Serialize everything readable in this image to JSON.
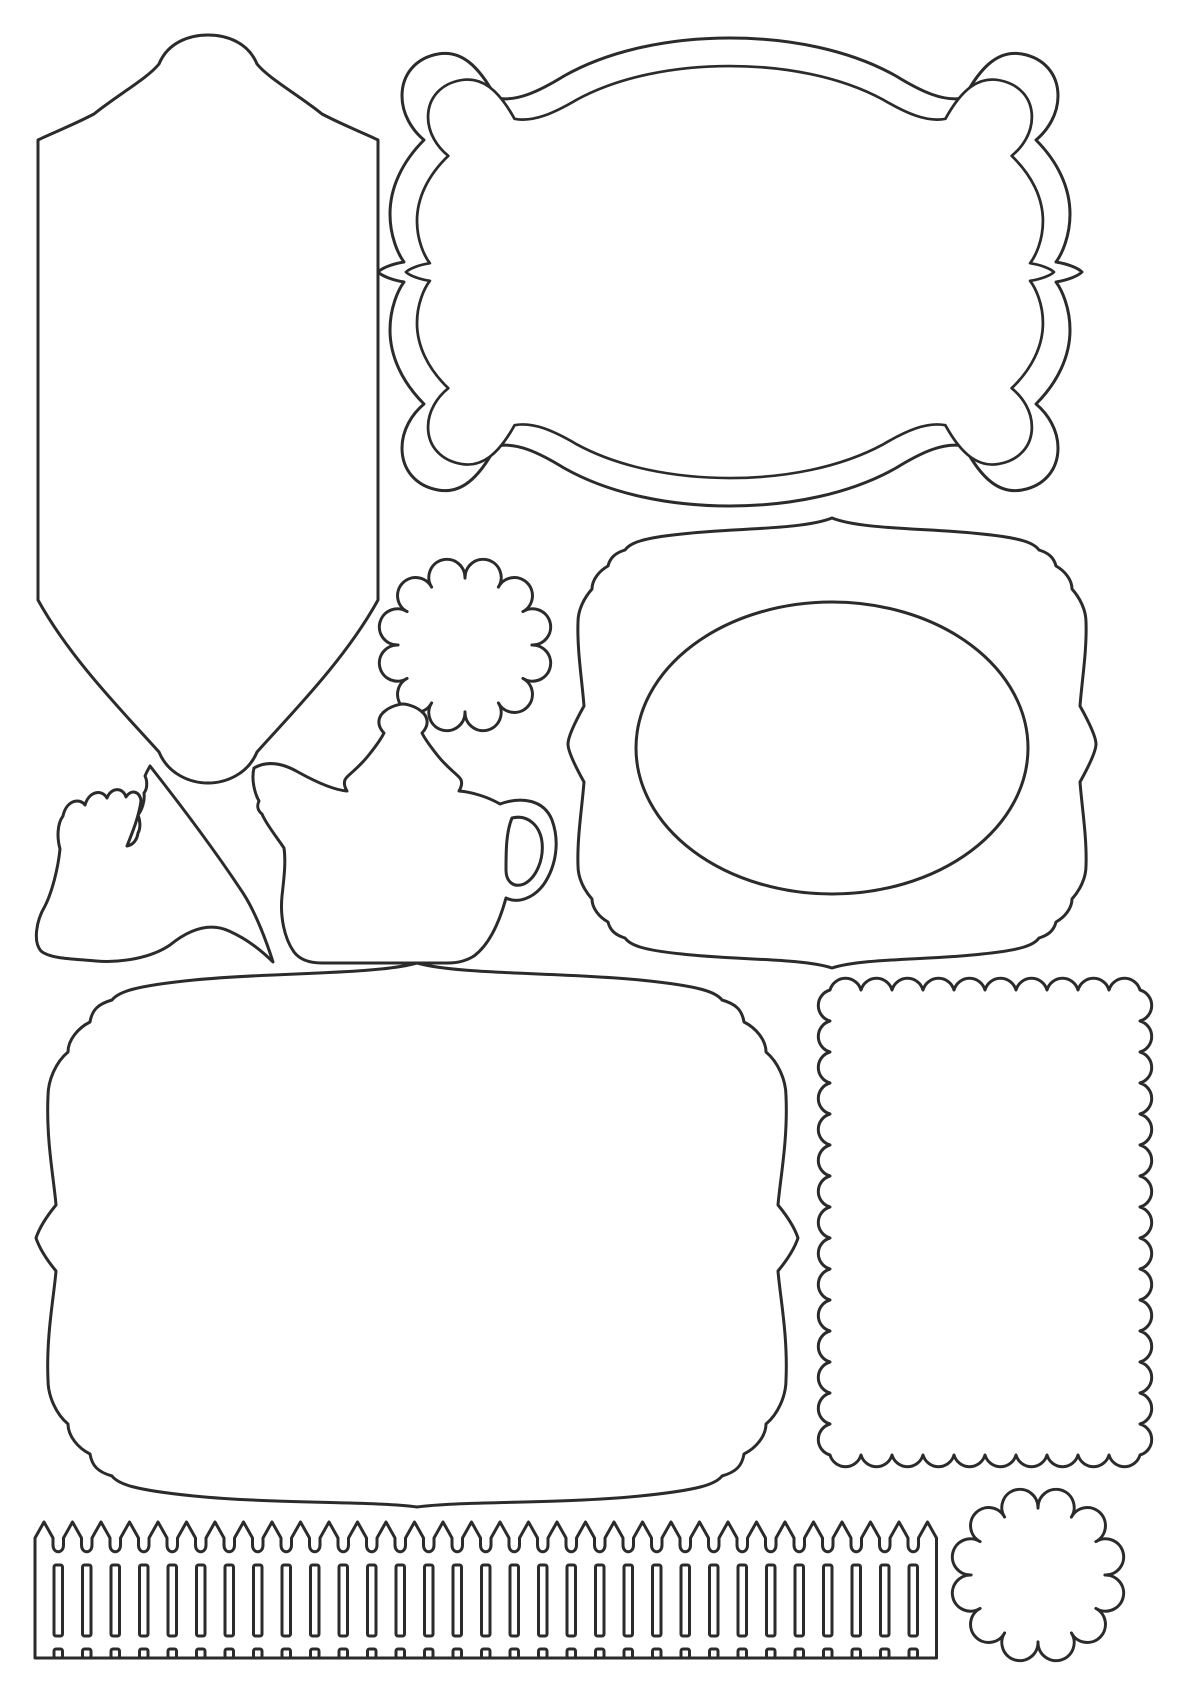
{
  "page": {
    "background_color": "#ffffff",
    "line_color": "#2b2b2b",
    "line_width": 3,
    "sheet_description": "Die-cut style craft template sheet of blank outline shapes: bracket frames, tall tag, oval frame, scalloped circles, scalloped rectangle, teapot, flying bird and picket fence"
  },
  "shapes": {
    "tall_label": {
      "label": "tall bracket tag",
      "bbox": [
        38,
        35,
        378,
        783
      ]
    },
    "double_bracket_frame": {
      "label": "double-outline bracket frame",
      "outlines": 2,
      "bbox": [
        375,
        33,
        1085,
        510
      ]
    },
    "scalloped_circle_large": {
      "label": "large scalloped circle",
      "center": [
        465,
        645
      ],
      "radius": 88,
      "lobes": 12
    },
    "teapot": {
      "label": "teapot outline",
      "bbox": [
        250,
        704,
        557,
        963
      ]
    },
    "bird": {
      "label": "flying bird outline",
      "bbox": [
        33,
        766,
        273,
        963
      ]
    },
    "oval_bracket_frame": {
      "label": "bracket frame with oval window",
      "bbox": [
        568,
        518,
        1096,
        968
      ],
      "oval_center": [
        832,
        748
      ],
      "oval_rx": 196,
      "oval_ry": 146
    },
    "large_bracket_frame": {
      "label": "large bracket frame",
      "bbox": [
        36,
        963,
        798,
        1507
      ]
    },
    "scalloped_rectangle": {
      "label": "scalloped rectangle frame",
      "x": 830,
      "y": 990,
      "width": 310,
      "height": 465,
      "scallop_radius": 15.5
    },
    "picket_fence": {
      "label": "picket fence border",
      "left": 35,
      "pickets": 32,
      "picket_width": 18,
      "pitch": 28.5,
      "tip_y": 1522,
      "shoulder_y": 1538,
      "valley_y": 1549,
      "slot_top": 1565,
      "slot_bottom": 1636,
      "notch_top": 1649,
      "bottom_y": 1658
    },
    "scalloped_circle_small": {
      "label": "small scalloped circle",
      "center": [
        1038,
        1575
      ],
      "radius": 88,
      "lobes": 12
    }
  }
}
